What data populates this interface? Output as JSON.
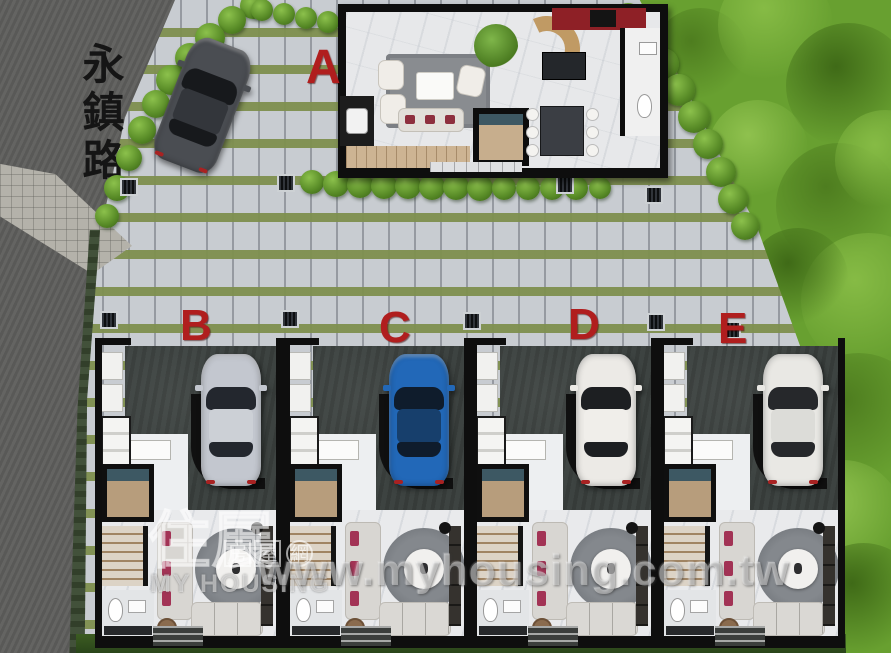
{
  "road": {
    "name": "永鎮路"
  },
  "units": {
    "a": {
      "label": "A"
    },
    "row": [
      {
        "label": "B",
        "car": {
          "body": "#c3c7cf",
          "roof": "#ccd0d6",
          "glass": "#23272e"
        }
      },
      {
        "label": "C",
        "car": {
          "body": "#2268b8",
          "roof": "#173f6c",
          "glass": "#0f1c2c"
        }
      },
      {
        "label": "D",
        "car": {
          "body": "#eceae6",
          "roof": "#f0eeea",
          "glass": "#1d1f22"
        }
      },
      {
        "label": "E",
        "car": {
          "body": "#e9e8e4",
          "roof": "#dcdcd8",
          "glass": "#26282b"
        }
      }
    ],
    "visitor_car": {
      "body": "#4a4d52",
      "roof": "#33363b",
      "glass": "#17191c"
    }
  },
  "watermark": {
    "cn_large": "住展",
    "cn_boxed_1": "房",
    "cn_boxed_2": "屋",
    "cn_circle": "網",
    "en_line": "MY HOUSING",
    "url": "www.myhousing.com.tw"
  },
  "palette": {
    "letter_red": "#b01e1e",
    "road_asphalt": "#5e5e5c",
    "paver": "#c8ccd1",
    "grass_strip": "#7e8f4e",
    "lawn": "#68a030",
    "carport": "#3d4341",
    "wall": "#0e0e0e"
  }
}
